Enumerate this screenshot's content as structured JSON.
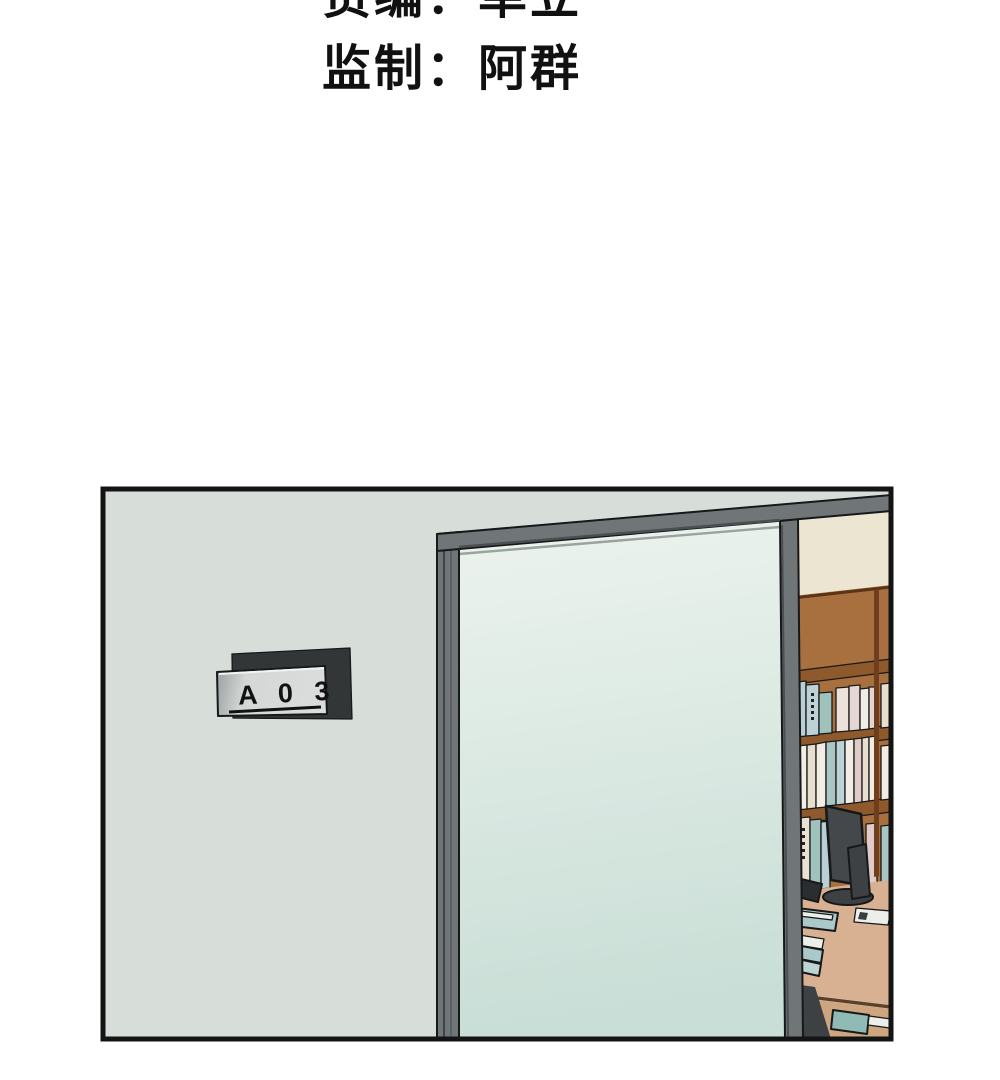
{
  "credits": {
    "line1": "责编：单立",
    "line2": "监制：阿群"
  },
  "panel": {
    "door_sign_text": "A 0 3"
  },
  "palette": {
    "page_bg": "#ffffff",
    "outline": "#17181a",
    "wall": "#d7ded9",
    "frame_gray": "#707578",
    "frame_gray_dark": "#4a4f52",
    "glass_top": "#edf3ee",
    "glass_bottom": "#c8ded6",
    "sign_backplate": "#333637",
    "sign_plate_edge": "#9aa09f",
    "sign_plate_light": "#d4d7d6",
    "interior_wall": "#ece5d1",
    "shelf_wood": "#a8703f",
    "shelf_wood_dark": "#8f5a2b",
    "shelf_divider": "#6f3f1d",
    "book_white": "#f1ede5",
    "book_cream": "#e7decd",
    "book_cream2": "#e9e1d1",
    "book_teal": "#9fc2bd",
    "book_teal2": "#a9c6c2",
    "book_blue": "#b9cfd3",
    "book_blue2": "#bdd2d6",
    "book_pink": "#e0cbc8",
    "book_pink2": "#e4d6d2",
    "book_pinkwhite": "#ece2da",
    "desk_top": "#d8b092",
    "desk_front": "#cda57f",
    "drawer_teal": "#8fbab5",
    "tray_teal": "#abc9c9",
    "tray_teal2": "#bcd4d2",
    "paper": "#eceee9",
    "monitor_body": "#45484b",
    "monitor_dark": "#2b2e30",
    "monitor_base": "#3e4144"
  }
}
